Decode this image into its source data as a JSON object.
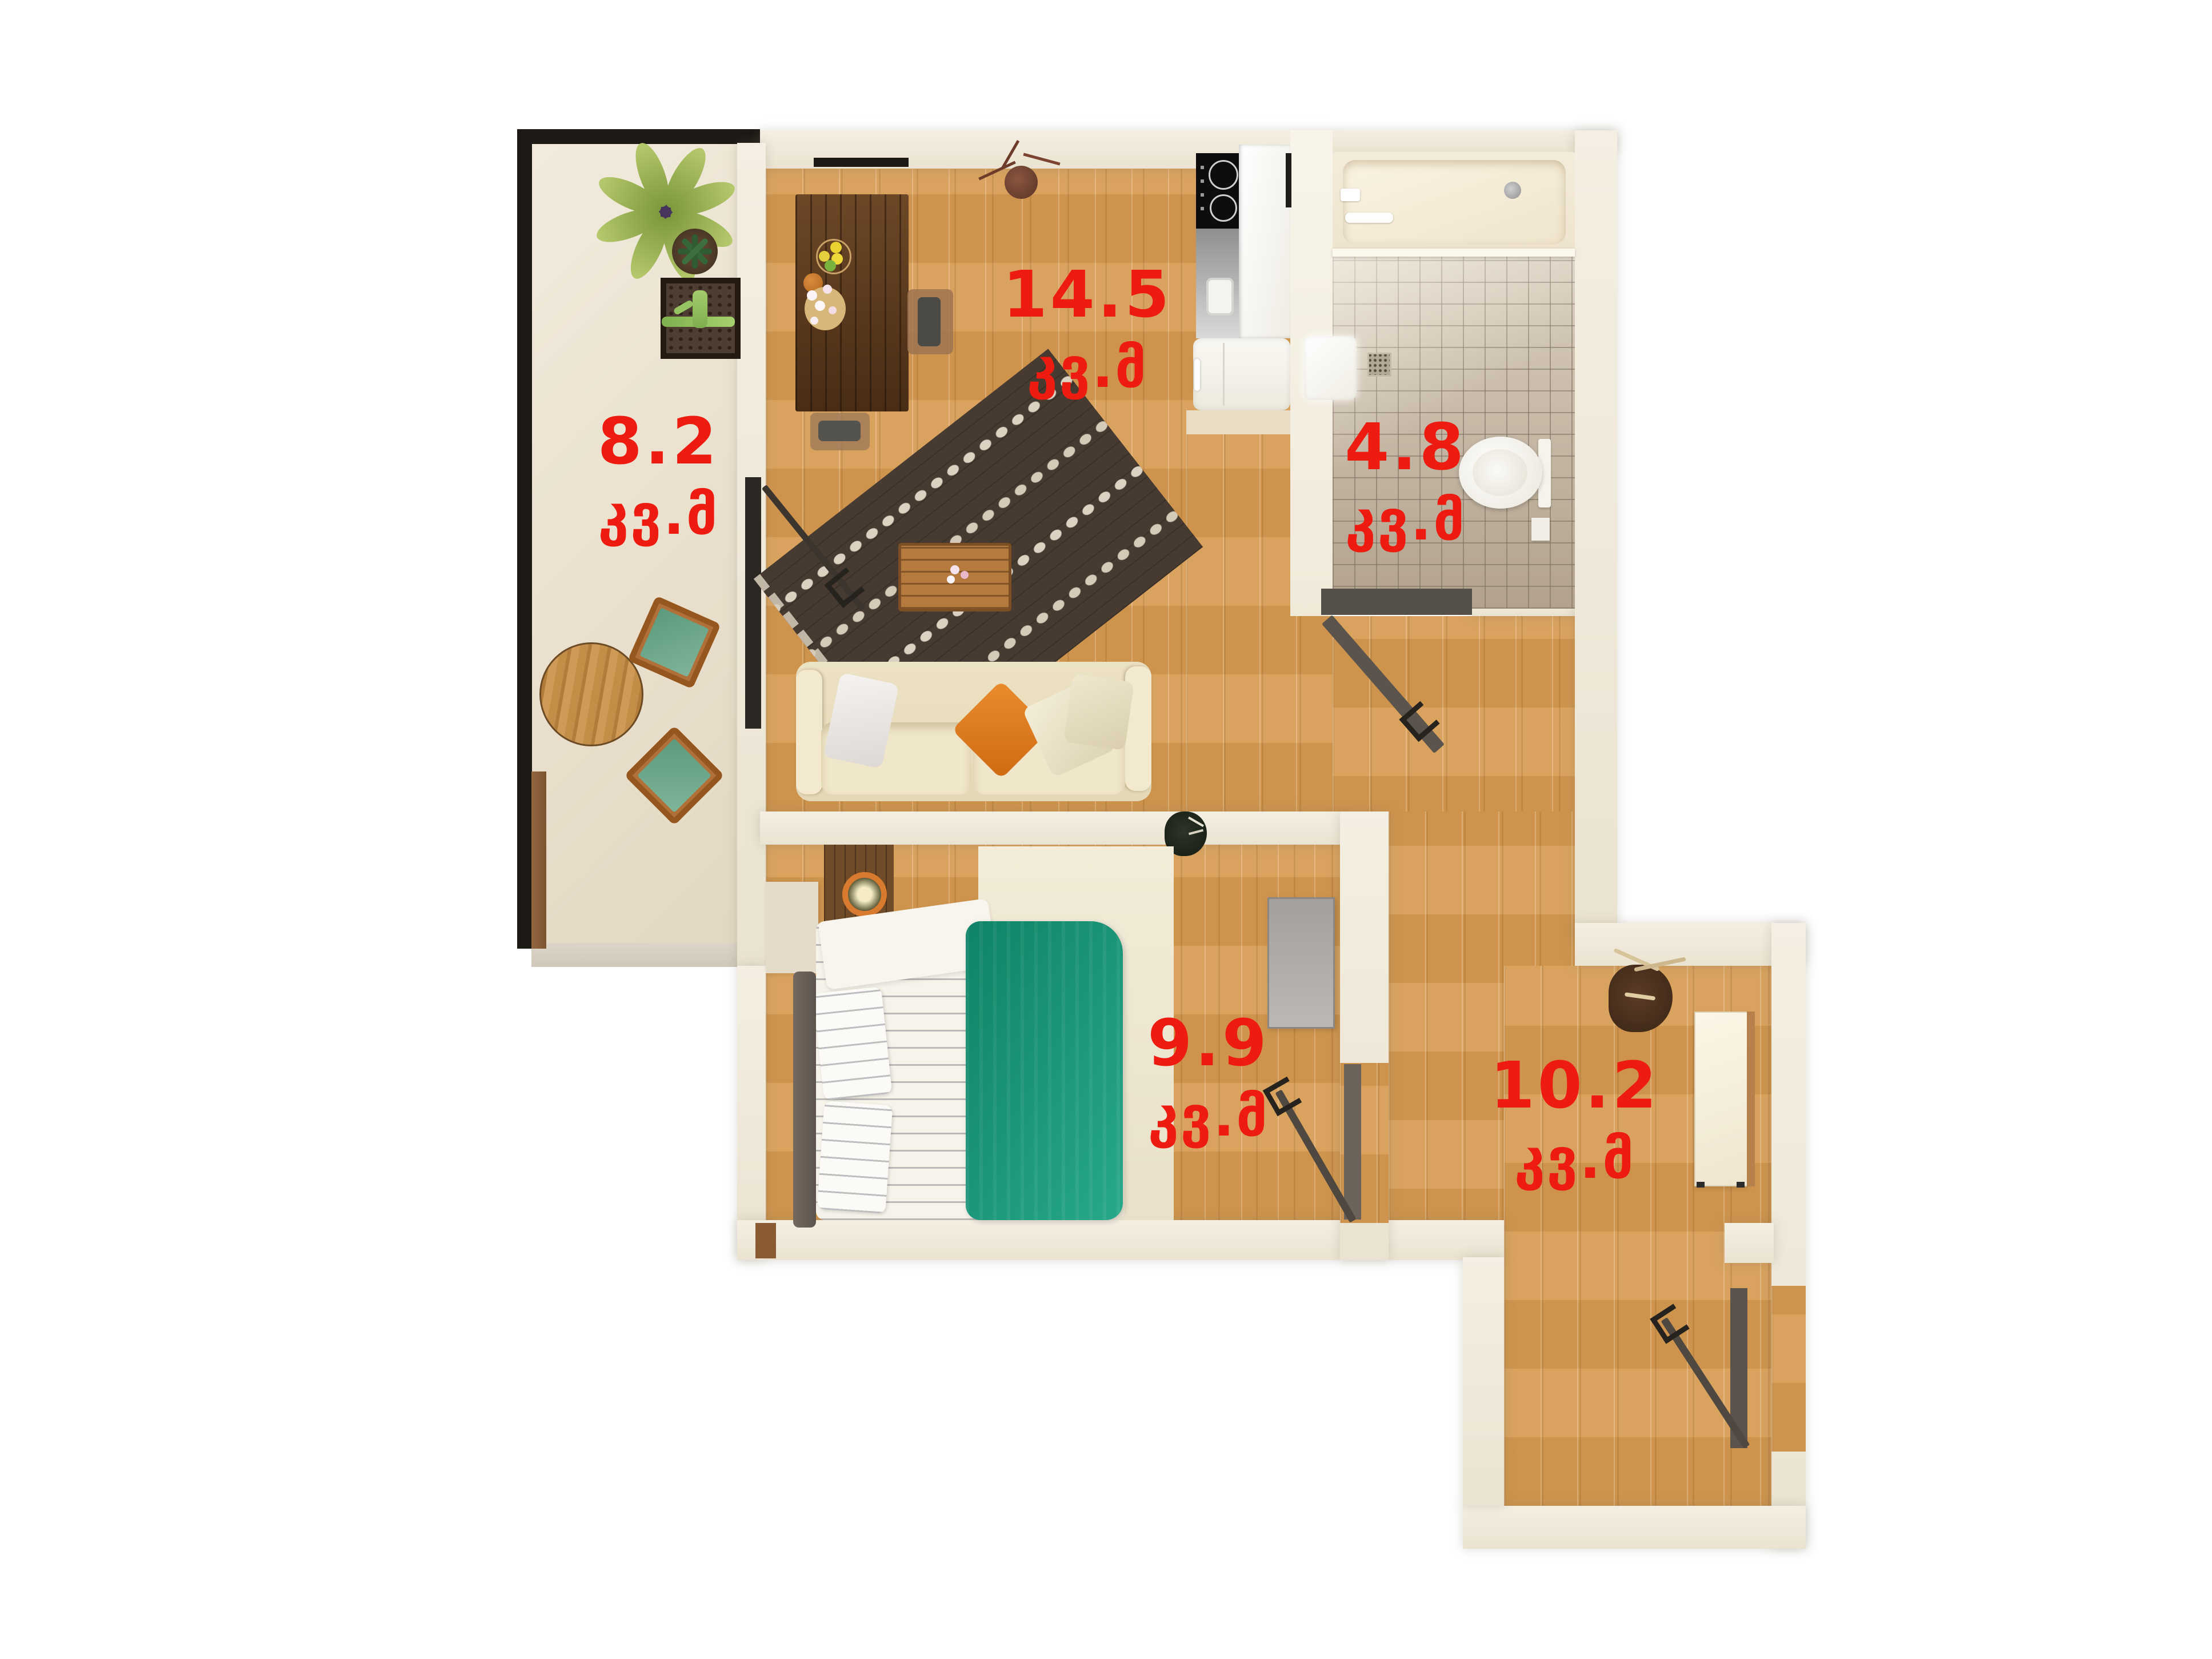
{
  "plan": {
    "unit_label": "კვ.მ",
    "rooms": [
      {
        "key": "living-room",
        "area": "14.5",
        "unit": "კვ.მ"
      },
      {
        "key": "balcony",
        "area": "8.2",
        "unit": "კვ.მ"
      },
      {
        "key": "bathroom",
        "area": "4.8",
        "unit": "კვ.მ"
      },
      {
        "key": "bedroom",
        "area": "9.9",
        "unit": "კვ.მ"
      },
      {
        "key": "hallway",
        "area": "10.2",
        "unit": "კვ.მ"
      }
    ],
    "colors": {
      "label_red": "#ee1b10",
      "floor_wood": "#d49a52",
      "balcony_floor": "#eae1cf",
      "wall_cream": "#f2ecdf",
      "tile_beige": "#cdc1b1",
      "blanket_teal": "#179376",
      "pillow_orange": "#e0761c",
      "door_dark": "#3b352d"
    }
  }
}
